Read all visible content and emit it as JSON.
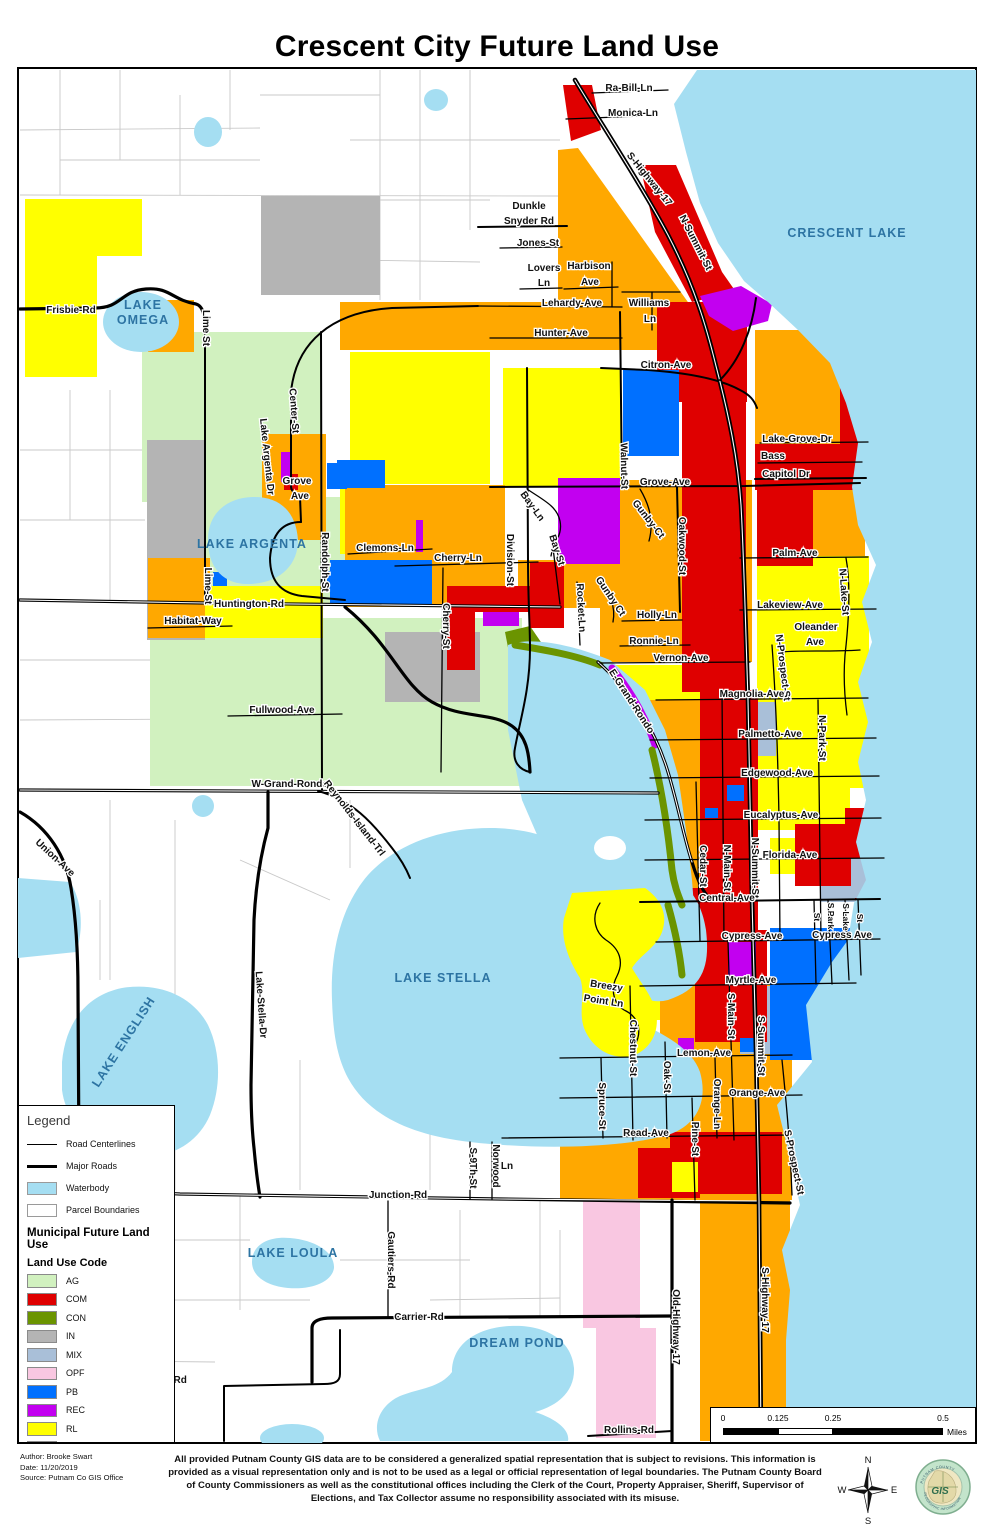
{
  "title": "Crescent City Future Land Use",
  "colors": {
    "waterbody": "#A5DEF2",
    "parcel_line": "#C9C9C9",
    "road": "#000000",
    "lake_label": "#2D74A3",
    "map_background": "#FFFFFF",
    "land_use": {
      "AG": "#D1F1BF",
      "COM": "#DF0000",
      "CON": "#6B9400",
      "IN": "#B4B4B4",
      "MIX": "#A9BFD8",
      "OPF": "#F9C7E1",
      "PB": "#0070FF",
      "REC": "#C200F0",
      "RL": "#FFFF00",
      "RM": "#FFA800"
    }
  },
  "legend": {
    "title": "Legend",
    "items": [
      {
        "label": "Road Centerlines",
        "swatch": "thin-line"
      },
      {
        "label": "Major Roads",
        "swatch": "thick-line"
      },
      {
        "label": "Waterbody",
        "swatch": "water-fill"
      },
      {
        "label": "Parcel Boundaries",
        "swatch": "parcel-fill"
      }
    ],
    "section_title": "Municipal Future Land Use",
    "subsection_title": "Land Use Code",
    "land_use": [
      {
        "code": "AG",
        "color": "#D1F1BF"
      },
      {
        "code": "COM",
        "color": "#DF0000"
      },
      {
        "code": "CON",
        "color": "#6B9400"
      },
      {
        "code": "IN",
        "color": "#B4B4B4"
      },
      {
        "code": "MIX",
        "color": "#A9BFD8"
      },
      {
        "code": "OPF",
        "color": "#F9C7E1"
      },
      {
        "code": "PB",
        "color": "#0070FF"
      },
      {
        "code": "REC",
        "color": "#C200F0"
      },
      {
        "code": "RL",
        "color": "#FFFF00"
      },
      {
        "code": "RM",
        "color": "#FFA800"
      }
    ]
  },
  "scale_bar": {
    "ticks": [
      "0",
      "0.125",
      "0.25",
      "0.5"
    ],
    "unit": "Miles"
  },
  "footer": {
    "author": "Author: Brooke Swart",
    "date": "Date: 11/20/2019",
    "source": "Source: Putnam Co GIS Office",
    "disclaimer": "All provided Putnam County GIS data are to be considered a generalized spatial representation that is subject to revisions. This information is provided as a visual representation only and is not to be used as a legal or official representation of legal boundaries. The Putnam County Board of County Commissioners as well as the constitutional offices including the Clerk of the Court, Property Appraiser, Sheriff, Supervisor of Elections, and Tax Collector assume no responsibility associated with its misuse.",
    "compass": {
      "n": "N",
      "e": "E",
      "s": "S",
      "w": "W"
    },
    "logo": {
      "center": "GIS",
      "ring_top": "PUTNAM COUNTY",
      "ring_bottom": "GEOGRAPHIC INFORMATION"
    }
  },
  "map": {
    "labels": [
      {
        "t": "LAKE",
        "x": 143,
        "y": 309,
        "k": "lake",
        "s": 11
      },
      {
        "t": "OMEGA",
        "x": 143,
        "y": 324,
        "k": "lake",
        "s": 11
      },
      {
        "t": "CRESCENT LAKE",
        "x": 847,
        "y": 237,
        "k": "lake",
        "s": 13
      },
      {
        "t": "LAKE ARGENTA",
        "x": 252,
        "y": 548,
        "k": "lake"
      },
      {
        "t": "LAKE STELLA",
        "x": 443,
        "y": 982,
        "k": "lake"
      },
      {
        "t": "LAKE ENGLISH",
        "x": 127,
        "y": 1044,
        "r": -57,
        "k": "lake"
      },
      {
        "t": "LAKE LOULA",
        "x": 293,
        "y": 1257,
        "k": "lake"
      },
      {
        "t": "DREAM POND",
        "x": 517,
        "y": 1347,
        "k": "lake"
      },
      {
        "t": "Ra-Bill-Ln",
        "x": 629,
        "y": 91
      },
      {
        "t": "Monica-Ln",
        "x": 633,
        "y": 116
      },
      {
        "t": "S-Highway-17",
        "x": 647,
        "y": 181,
        "r": 51
      },
      {
        "t": "N-Summit-St",
        "x": 693,
        "y": 244,
        "r": 63
      },
      {
        "t": "Dunkle",
        "x": 529,
        "y": 209
      },
      {
        "t": "Snyder Rd",
        "x": 529,
        "y": 224
      },
      {
        "t": "Jones-St",
        "x": 538,
        "y": 246
      },
      {
        "t": "Lovers",
        "x": 544,
        "y": 271
      },
      {
        "t": "Ln",
        "x": 544,
        "y": 286
      },
      {
        "t": "Harbison",
        "x": 589,
        "y": 269
      },
      {
        "t": "Ave",
        "x": 590,
        "y": 285
      },
      {
        "t": "Lehardy-Ave",
        "x": 572,
        "y": 306
      },
      {
        "t": "Williams",
        "x": 649,
        "y": 306
      },
      {
        "t": "Ln",
        "x": 650,
        "y": 322
      },
      {
        "t": "Hunter-Ave",
        "x": 561,
        "y": 336
      },
      {
        "t": "Citron-Ave",
        "x": 666,
        "y": 368
      },
      {
        "t": "Frisbie-Rd",
        "x": 71,
        "y": 313
      },
      {
        "t": "Lime St",
        "x": 203,
        "y": 328,
        "r": 90
      },
      {
        "t": "Center-St",
        "x": 291,
        "y": 411,
        "r": 86
      },
      {
        "t": "Lake Argenta Dr",
        "x": 264,
        "y": 457,
        "r": 84
      },
      {
        "t": "Grove",
        "x": 297,
        "y": 484
      },
      {
        "t": "Ave",
        "x": 300,
        "y": 499
      },
      {
        "t": "Grove-Ave",
        "x": 665,
        "y": 485
      },
      {
        "t": "Lake-Grove-Dr",
        "x": 797,
        "y": 442
      },
      {
        "t": "Bass",
        "x": 773,
        "y": 459
      },
      {
        "t": "Capitol Dr",
        "x": 786,
        "y": 477
      },
      {
        "t": "Clemons-Ln",
        "x": 385,
        "y": 551
      },
      {
        "t": "Cherry-Ln",
        "x": 458,
        "y": 561
      },
      {
        "t": "Division-St",
        "x": 507,
        "y": 560,
        "r": 90
      },
      {
        "t": "Bay-Ln",
        "x": 530,
        "y": 508,
        "r": 54
      },
      {
        "t": "Bay-St",
        "x": 554,
        "y": 551,
        "r": 72
      },
      {
        "t": "Gunby-Ct",
        "x": 646,
        "y": 521,
        "r": 52
      },
      {
        "t": "Oakwood-St",
        "x": 679,
        "y": 546,
        "r": 90
      },
      {
        "t": "Walnut-St",
        "x": 621,
        "y": 466,
        "r": 89
      },
      {
        "t": "Huntington-Rd",
        "x": 249,
        "y": 607
      },
      {
        "t": "Habitat-Way",
        "x": 193,
        "y": 624
      },
      {
        "t": "Lime-St",
        "x": 205,
        "y": 586,
        "r": 90
      },
      {
        "t": "Randolph-St",
        "x": 322,
        "y": 562,
        "r": 90
      },
      {
        "t": "Cherry-St",
        "x": 443,
        "y": 626,
        "r": 90
      },
      {
        "t": "Rocket-Ln",
        "x": 578,
        "y": 608,
        "r": 87
      },
      {
        "t": "Gunby Ct",
        "x": 608,
        "y": 598,
        "r": 56
      },
      {
        "t": "Holly-Ln",
        "x": 657,
        "y": 618
      },
      {
        "t": "Ronnie-Ln",
        "x": 654,
        "y": 644
      },
      {
        "t": "Vernon-Ave",
        "x": 681,
        "y": 661
      },
      {
        "t": "E-Grand-Rondo",
        "x": 629,
        "y": 703,
        "r": 57
      },
      {
        "t": "Palm-Ave",
        "x": 795,
        "y": 556
      },
      {
        "t": "Lakeview-Ave",
        "x": 790,
        "y": 608
      },
      {
        "t": "N-Lake-St",
        "x": 841,
        "y": 592,
        "r": 86
      },
      {
        "t": "Oleander",
        "x": 816,
        "y": 630
      },
      {
        "t": "Ave",
        "x": 815,
        "y": 645
      },
      {
        "t": "N-Prospect-St",
        "x": 780,
        "y": 668,
        "r": 83
      },
      {
        "t": "Magnolia-Ave",
        "x": 752,
        "y": 697
      },
      {
        "t": "N-Park-St",
        "x": 819,
        "y": 738,
        "r": 90
      },
      {
        "t": "Palmetto-Ave",
        "x": 770,
        "y": 737
      },
      {
        "t": "Edgewood-Ave",
        "x": 777,
        "y": 776
      },
      {
        "t": "Eucalyptus-Ave",
        "x": 781,
        "y": 818
      },
      {
        "t": "Cedar-St",
        "x": 700,
        "y": 866,
        "r": 90
      },
      {
        "t": "N-Main-St",
        "x": 724,
        "y": 868,
        "r": 90
      },
      {
        "t": "N-Summit-St",
        "x": 752,
        "y": 868,
        "r": 90
      },
      {
        "t": "Florida-Ave",
        "x": 790,
        "y": 858
      },
      {
        "t": "Central-Ave",
        "x": 727,
        "y": 901
      },
      {
        "t": "Cypress-Ave",
        "x": 752,
        "y": 939
      },
      {
        "t": "Cypress Ave",
        "x": 842,
        "y": 938
      },
      {
        "t": "St",
        "x": 814,
        "y": 917,
        "r": 90,
        "k": "sm"
      },
      {
        "t": "S Park",
        "x": 828,
        "y": 916,
        "r": 90,
        "k": "sm"
      },
      {
        "t": "S Lake",
        "x": 843,
        "y": 917,
        "r": 90,
        "k": "sm"
      },
      {
        "t": "St",
        "x": 857,
        "y": 918,
        "r": 90,
        "k": "sm"
      },
      {
        "t": "Myrtle-Ave",
        "x": 751,
        "y": 983
      },
      {
        "t": "S-Main-St",
        "x": 728,
        "y": 1016,
        "r": 90
      },
      {
        "t": "S-Summit-St",
        "x": 758,
        "y": 1046,
        "r": 90
      },
      {
        "t": "Breezy",
        "x": 606,
        "y": 989,
        "r": 9
      },
      {
        "t": "Point Ln",
        "x": 603,
        "y": 1004,
        "r": 9
      },
      {
        "t": "Chestnut-St",
        "x": 630,
        "y": 1048,
        "r": 90
      },
      {
        "t": "Oak-St",
        "x": 664,
        "y": 1077,
        "r": 90
      },
      {
        "t": "Spruce-St",
        "x": 599,
        "y": 1106,
        "r": 90
      },
      {
        "t": "Lemon-Ave",
        "x": 704,
        "y": 1056
      },
      {
        "t": "Orange-Ln",
        "x": 714,
        "y": 1104,
        "r": 90
      },
      {
        "t": "Orange-Ave",
        "x": 757,
        "y": 1096
      },
      {
        "t": "Pine-St",
        "x": 692,
        "y": 1139,
        "r": 90
      },
      {
        "t": "Read-Ave",
        "x": 646,
        "y": 1136
      },
      {
        "t": "S-9Th-St",
        "x": 470,
        "y": 1168,
        "r": 90
      },
      {
        "t": "Norwood",
        "x": 493,
        "y": 1166,
        "r": 90
      },
      {
        "t": "Ln",
        "x": 507,
        "y": 1169
      },
      {
        "t": "Junction-Rd",
        "x": 398,
        "y": 1198
      },
      {
        "t": "Gautiers-Rd",
        "x": 388,
        "y": 1260,
        "r": 90
      },
      {
        "t": "Carrier-Rd",
        "x": 419,
        "y": 1320
      },
      {
        "t": "nver-Rd",
        "x": 168,
        "y": 1383
      },
      {
        "t": "Rollins-Rd",
        "x": 629,
        "y": 1433
      },
      {
        "t": "Old-Highway-17",
        "x": 673,
        "y": 1327,
        "r": 90
      },
      {
        "t": "S-Highway-17",
        "x": 762,
        "y": 1300,
        "r": 90
      },
      {
        "t": "S-Prospect-St",
        "x": 791,
        "y": 1163,
        "r": 78
      },
      {
        "t": "Fullwood-Ave",
        "x": 282,
        "y": 713
      },
      {
        "t": "W-Grand-Rondo",
        "x": 290,
        "y": 787
      },
      {
        "t": "Reynolds-Island-Trl",
        "x": 352,
        "y": 820,
        "r": 52
      },
      {
        "t": "Union-Ave",
        "x": 53,
        "y": 860,
        "r": 43
      },
      {
        "t": "Lake-Stella-Dr",
        "x": 258,
        "y": 1005,
        "r": 86
      }
    ]
  }
}
